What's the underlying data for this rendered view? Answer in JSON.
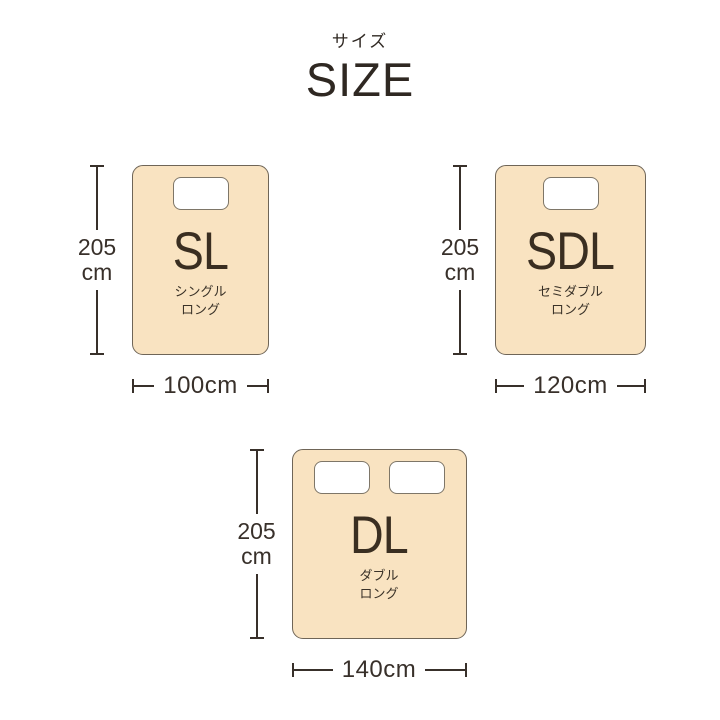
{
  "header": {
    "subtitle_jp": "サイズ",
    "title": "SIZE"
  },
  "colors": {
    "background": "#ffffff",
    "mattress_fill": "#f9e3c1",
    "mattress_border": "#6f6557",
    "pillow_fill": "#ffffff",
    "pillow_border": "#7e7668",
    "dimension_line": "#38302a",
    "text_dark": "#3a2e21"
  },
  "sizes": [
    {
      "abbr": "SL",
      "name_jp": [
        "シングル",
        "ロング"
      ],
      "height_value": "205",
      "height_unit": "cm",
      "width_label": "100cm",
      "pillow_count": 1
    },
    {
      "abbr": "SDL",
      "name_jp": [
        "セミダブル",
        "ロング"
      ],
      "height_value": "205",
      "height_unit": "cm",
      "width_label": "120cm",
      "pillow_count": 1
    },
    {
      "abbr": "DL",
      "name_jp": [
        "ダブル",
        "ロング"
      ],
      "height_value": "205",
      "height_unit": "cm",
      "width_label": "140cm",
      "pillow_count": 2
    }
  ]
}
